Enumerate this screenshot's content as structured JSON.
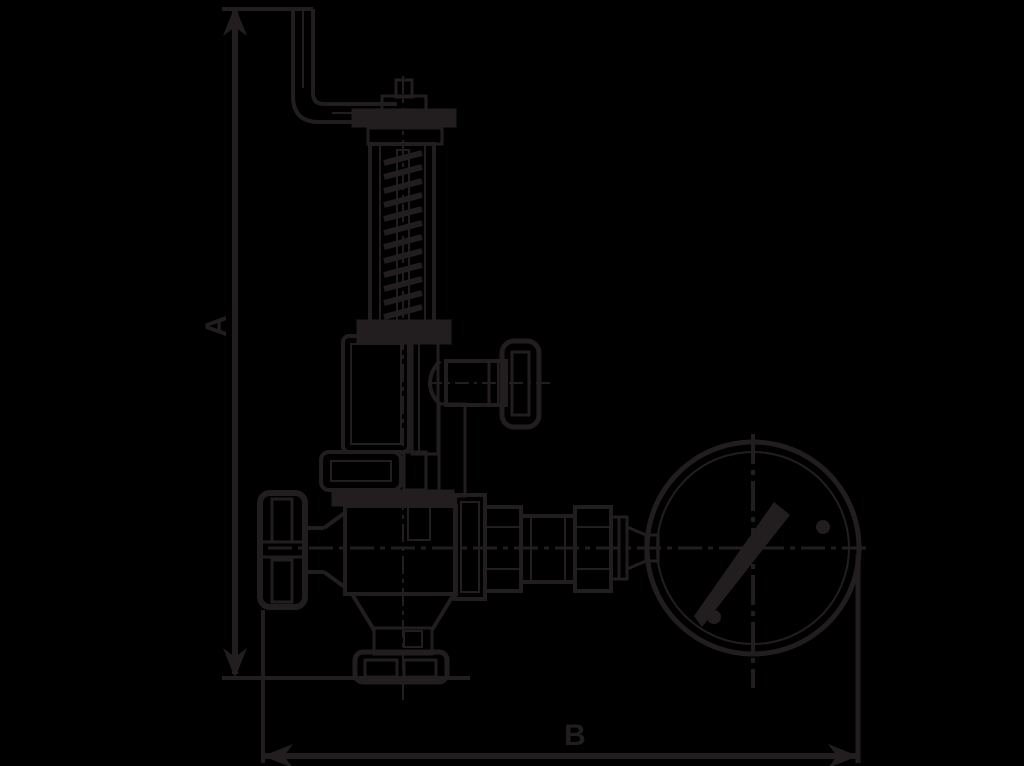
{
  "diagram": {
    "type": "technical-drawing",
    "background_color": "#000000",
    "line_color": "#221e1f",
    "dimension_labels": {
      "height": "A",
      "width": "B"
    },
    "parts": [
      "lever-arm",
      "adjusting-cap",
      "spring-housing",
      "upper-valve-body",
      "gland-nut",
      "side-handwheel",
      "left-handwheel",
      "lower-valve-body",
      "bottom-flange",
      "outlet-fittings",
      "pressure-gauge"
    ]
  }
}
